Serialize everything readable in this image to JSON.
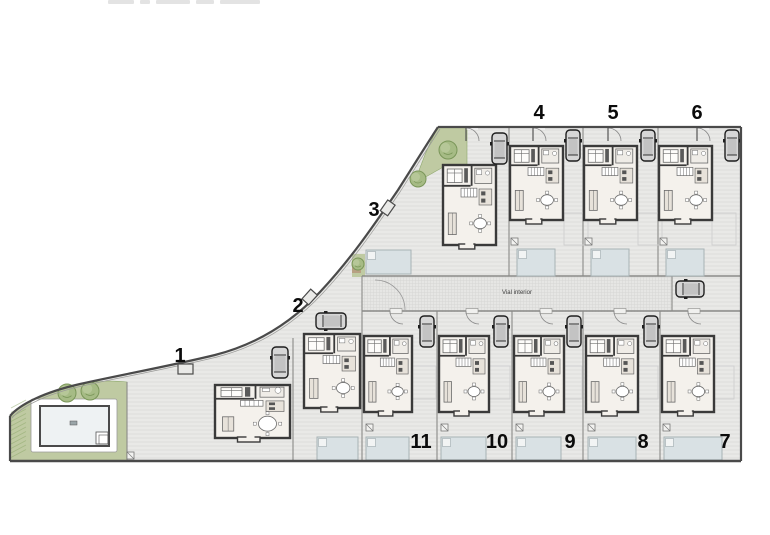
{
  "plan": {
    "title": "Residential site plan",
    "road": {
      "label": "Vial interior",
      "rect": [
        362,
        276,
        310,
        36
      ],
      "ext_rect": [
        672,
        276,
        69,
        35
      ]
    },
    "units": [
      {
        "id": "1",
        "label": "1",
        "label_pos": [
          180,
          362
        ],
        "house": [
          215,
          385,
          75,
          53
        ],
        "car": [
          272,
          347,
          16,
          31,
          "v"
        ],
        "pool": null
      },
      {
        "id": "2",
        "label": "2",
        "label_pos": [
          298,
          312
        ],
        "house": [
          304,
          334,
          56,
          74
        ],
        "car": [
          316,
          313,
          30,
          16,
          "h"
        ],
        "pool": [
          317,
          437,
          41,
          23
        ]
      },
      {
        "id": "3",
        "label": "3",
        "label_pos": [
          374,
          216
        ],
        "house": [
          443,
          165,
          53,
          80
        ],
        "car": [
          492,
          133,
          15,
          31,
          "v"
        ],
        "pool": [
          366,
          250,
          45,
          24
        ]
      },
      {
        "id": "4",
        "label": "4",
        "label_pos": [
          539,
          119
        ],
        "house": [
          510,
          146,
          53,
          74
        ],
        "car": [
          566,
          130,
          14,
          31,
          "v"
        ],
        "pool": [
          517,
          249,
          38,
          27
        ]
      },
      {
        "id": "5",
        "label": "5",
        "label_pos": [
          613,
          119
        ],
        "house": [
          584,
          146,
          53,
          74
        ],
        "car": [
          641,
          130,
          14,
          31,
          "v"
        ],
        "pool": [
          591,
          249,
          38,
          27
        ]
      },
      {
        "id": "6",
        "label": "6",
        "label_pos": [
          697,
          119
        ],
        "house": [
          659,
          146,
          53,
          74
        ],
        "car": [
          725,
          130,
          14,
          31,
          "v"
        ],
        "pool": [
          666,
          249,
          38,
          27
        ]
      },
      {
        "id": "7",
        "label": "7",
        "label_pos": [
          725,
          448
        ],
        "house": [
          662,
          336,
          52,
          76
        ],
        "car": [
          676,
          281,
          28,
          16,
          "h"
        ],
        "pool": [
          664,
          437,
          58,
          23
        ]
      },
      {
        "id": "8",
        "label": "8",
        "label_pos": [
          643,
          448
        ],
        "house": [
          586,
          336,
          52,
          76
        ],
        "car": [
          644,
          316,
          14,
          31,
          "v"
        ],
        "pool": [
          588,
          437,
          48,
          23
        ]
      },
      {
        "id": "9",
        "label": "9",
        "label_pos": [
          570,
          448
        ],
        "house": [
          514,
          336,
          50,
          76
        ],
        "car": [
          567,
          316,
          14,
          31,
          "v"
        ],
        "pool": [
          516,
          437,
          45,
          23
        ]
      },
      {
        "id": "10",
        "label": "10",
        "label_pos": [
          497,
          448
        ],
        "house": [
          439,
          336,
          50,
          76
        ],
        "car": [
          494,
          316,
          14,
          31,
          "v"
        ],
        "pool": [
          441,
          437,
          45,
          23
        ]
      },
      {
        "id": "11",
        "label": "11",
        "label_pos": [
          421,
          448
        ],
        "house": [
          364,
          336,
          48,
          76
        ],
        "car": [
          420,
          316,
          14,
          31,
          "v"
        ],
        "pool": [
          366,
          437,
          43,
          23
        ]
      }
    ],
    "geometry": {
      "interior_path": "M438,127 H741 V461 H10 V416 C 20,404 45,392 80,384 C 120,375 170,366 215,355 C 258,344 292,322 320,292 C 350,260 372,228 398,190 C 412,168 425,147 438,127 Z",
      "curve_path": "M10,416 C 20,404 45,392 80,384 C 120,375 170,366 215,355 C 258,344 292,322 320,292 C 350,260 372,228 398,190 C 412,168 425,147 438,127",
      "boundary": {
        "top": [
          438,
          127,
          741,
          127
        ],
        "right": [
          741,
          127,
          741,
          461
        ],
        "bottom": [
          10,
          461,
          741,
          461
        ],
        "left": [
          10,
          416,
          10,
          461
        ]
      },
      "plot_lines_v": [
        [
          509,
          128,
          276
        ],
        [
          583,
          128,
          276
        ],
        [
          658,
          128,
          276
        ],
        [
          362,
          276,
          461
        ],
        [
          437,
          311,
          461
        ],
        [
          512,
          311,
          461
        ],
        [
          583,
          311,
          461
        ],
        [
          660,
          311,
          461
        ],
        [
          672,
          276,
          311
        ],
        [
          127,
          382,
          461
        ],
        [
          293,
          338,
          461
        ]
      ],
      "plot_lines_h": [
        [
          362,
          741,
          276
        ],
        [
          362,
          741,
          311
        ]
      ],
      "gates_top": [
        466,
        533,
        608,
        697
      ],
      "gates_bottom": [
        390,
        466,
        540,
        614,
        688
      ],
      "curve_notches": [
        {
          "rect": [
            178,
            364,
            15,
            10
          ],
          "rotate": null
        },
        {
          "rect": [
            303,
            293,
            13,
            9
          ],
          "rotate": [
            -48,
            309,
            297
          ]
        },
        {
          "rect": [
            381,
            204,
            13,
            9
          ],
          "rotate": [
            -55,
            387,
            208
          ]
        }
      ],
      "terraces": [
        [
          564,
          213,
          24,
          32
        ],
        [
          638,
          213,
          24,
          32
        ],
        [
          712,
          213,
          24,
          32
        ],
        [
          412,
          366,
          24,
          33
        ],
        [
          487,
          366,
          23,
          33
        ],
        [
          560,
          366,
          22,
          33
        ],
        [
          634,
          366,
          24,
          33
        ],
        [
          710,
          366,
          24,
          33
        ]
      ],
      "utility_boxes": [
        [
          511,
          238
        ],
        [
          585,
          238
        ],
        [
          660,
          238
        ],
        [
          366,
          424
        ],
        [
          441,
          424
        ],
        [
          516,
          424
        ],
        [
          588,
          424
        ],
        [
          663,
          424
        ],
        [
          127,
          452
        ]
      ],
      "green_left_path": "M10,461 V416 C 20,404 45,392 80,384 C 103,380 116,381 127,382 V461 Z",
      "green_wedge_path": "M438,127 H467 V166 H445 L415,183 C 421,163 429,144 438,127 Z",
      "green_patch": {
        "green": [
          352,
          254,
          13,
          23
        ],
        "brown": [
          352,
          262,
          9,
          11
        ]
      },
      "trees": [
        [
          67,
          393,
          9
        ],
        [
          90,
          391,
          9
        ],
        [
          448,
          150,
          9
        ],
        [
          418,
          179,
          8
        ],
        [
          358,
          264,
          6
        ]
      ],
      "communal_pool": {
        "deck": [
          31,
          399,
          86,
          53
        ],
        "water": [
          40,
          406,
          69,
          40
        ],
        "ladder": [
          70,
          421
        ],
        "steps": [
          96,
          432,
          12,
          12
        ]
      }
    },
    "colors": {
      "ground": "#e9e9e7",
      "ground_line": "#dadad8",
      "road": "#e6e6e4",
      "road_line": "#d6d6d4",
      "wall": "#3a3a3a",
      "boundary": "#4a4a4a",
      "plot_line": "#8a8a88",
      "green": "#bfcaa2",
      "green_dark": "#8fa96d",
      "tree": "#a6bb85",
      "tree_edge": "#7a9659",
      "pool": "#d9e1e4",
      "pool_edge": "#a7b2b5",
      "pool_deck": "#ffffff",
      "house_fill": "#f4f1ec",
      "furn_line": "#6b6b6b",
      "furn_fill": "#e7e2da",
      "car_body": "#d6d6d6",
      "car_roof": "#c3c3c3",
      "car_line": "#1f1f1f",
      "label": "#0b0b0b",
      "faint": "#cfcfcf",
      "brown": "#b59a7e",
      "road_text": "#3c3c3c"
    }
  }
}
